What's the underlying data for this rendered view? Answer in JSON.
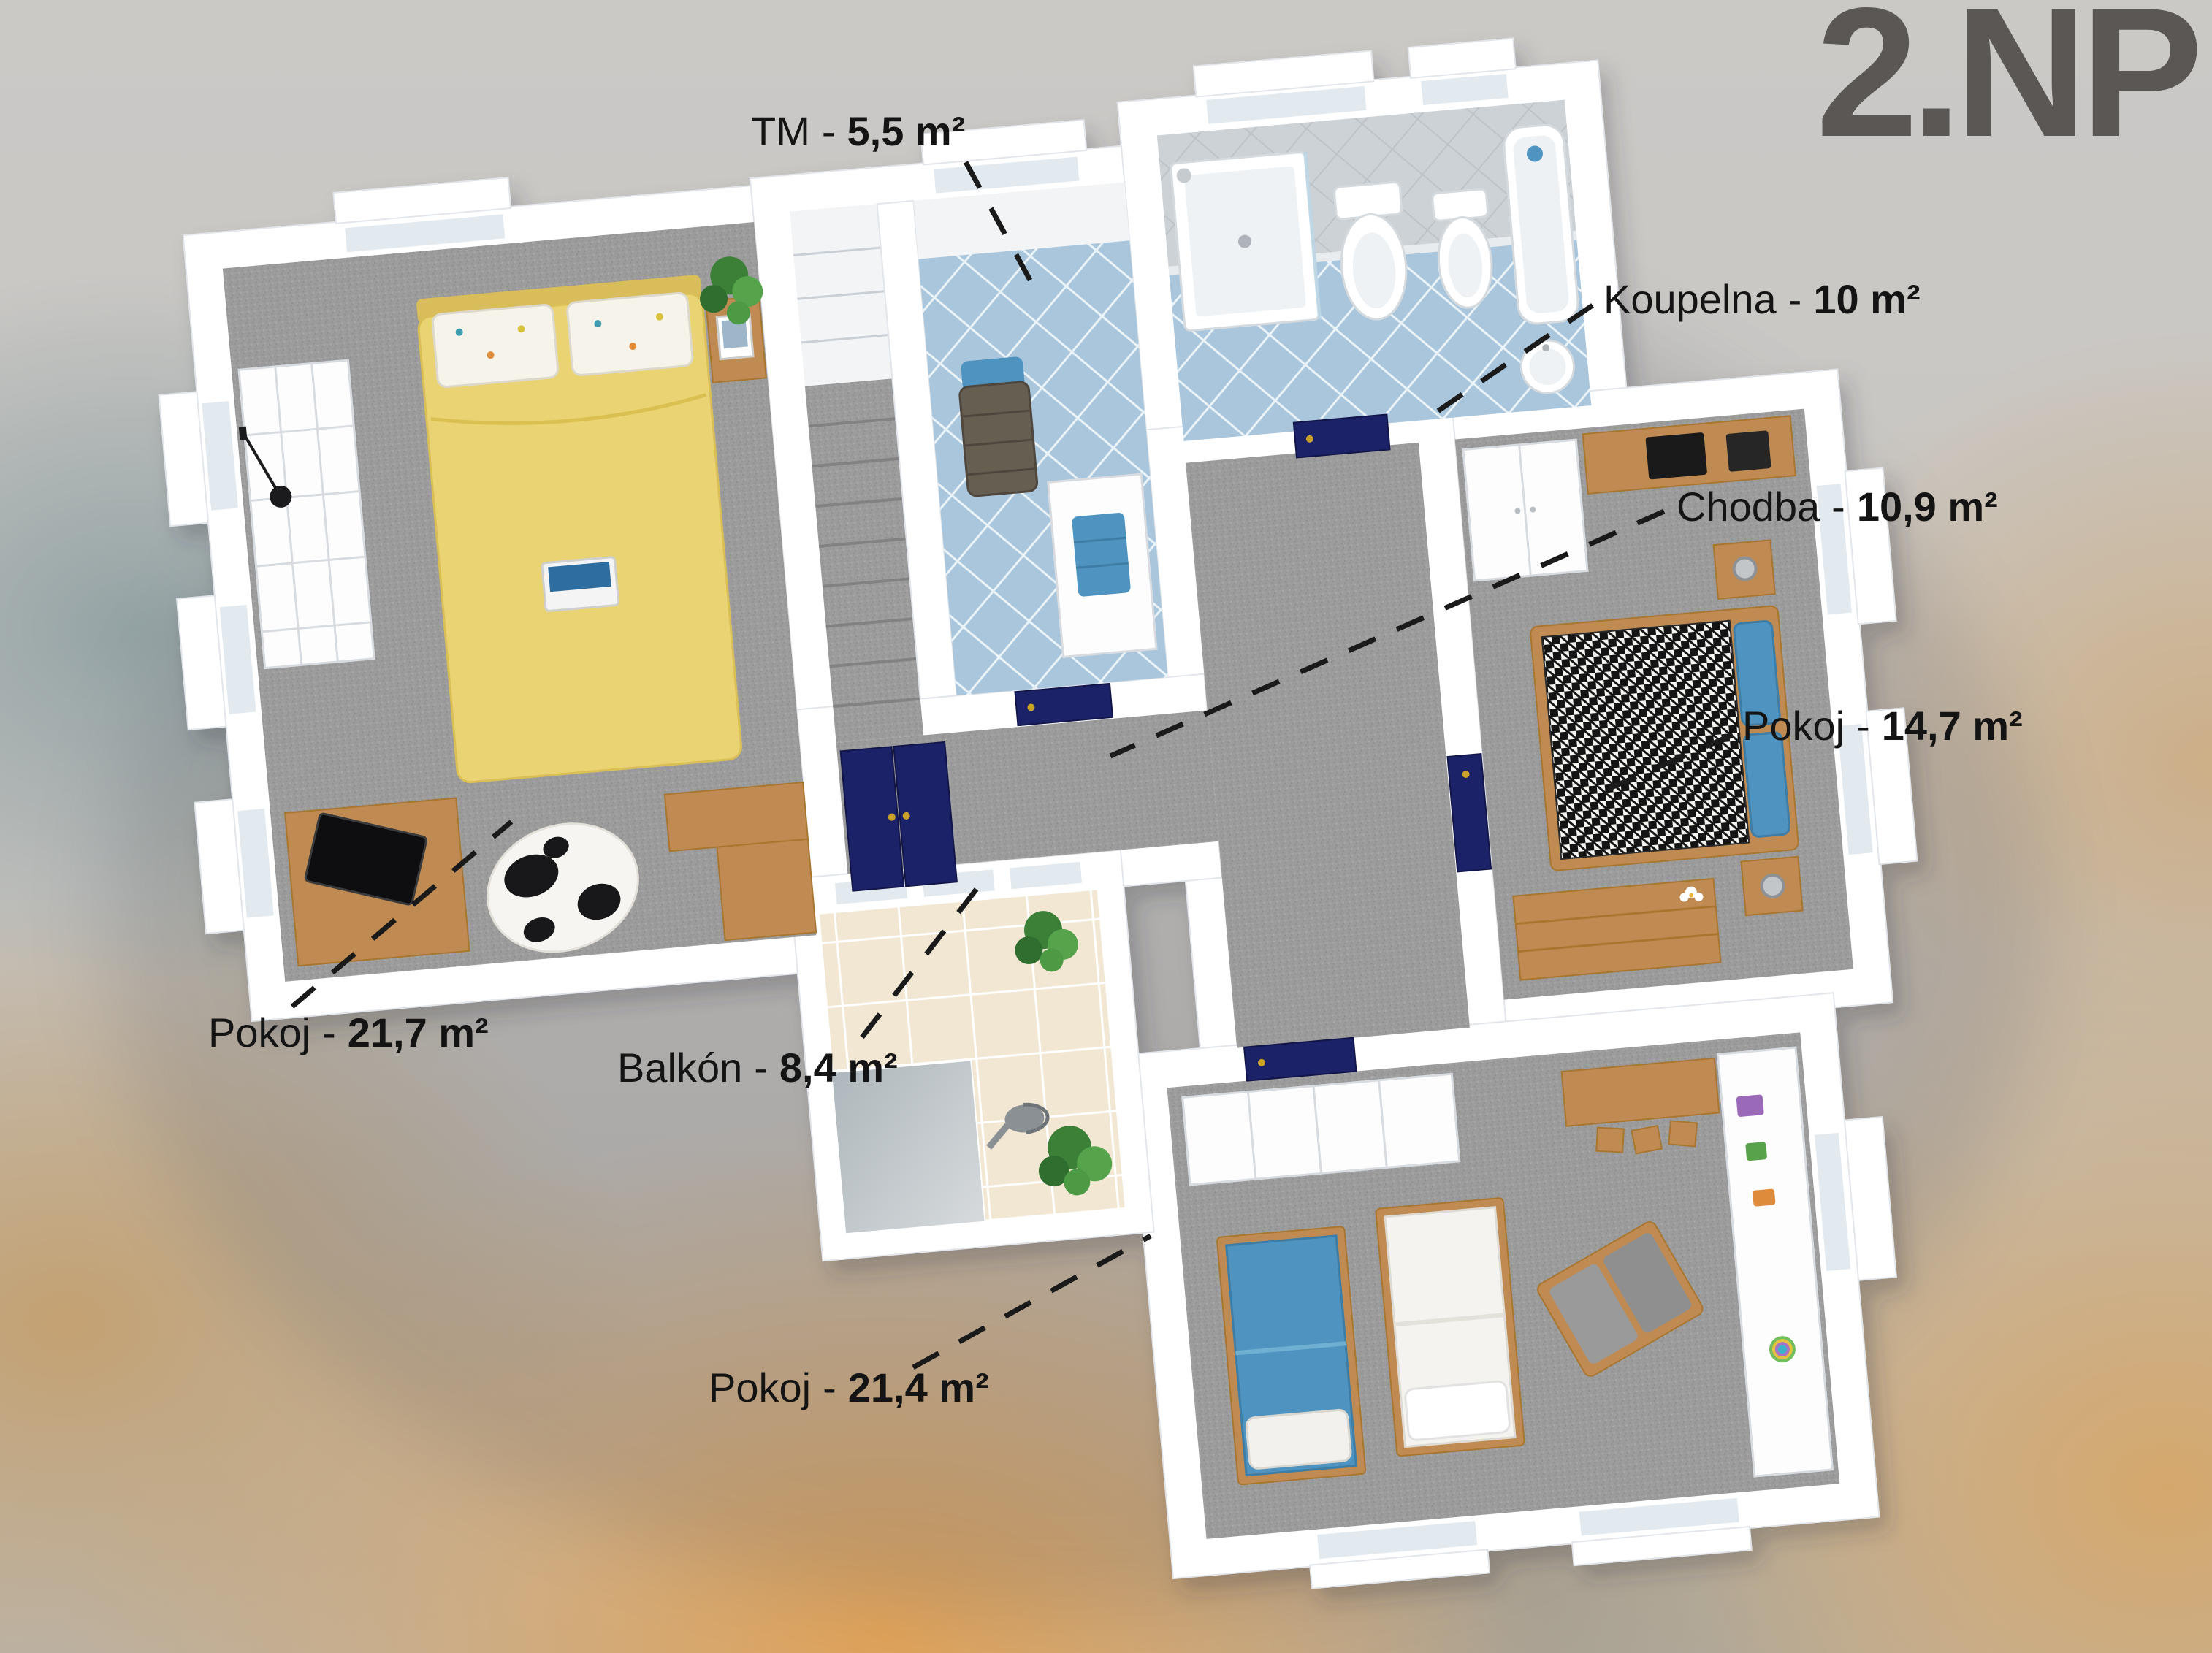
{
  "title": "2.NP",
  "separator": "-",
  "rooms": [
    {
      "id": "tm",
      "name": "TM",
      "area": "5,5 m²"
    },
    {
      "id": "koupelna",
      "name": "Koupelna",
      "area": "10 m²"
    },
    {
      "id": "chodba",
      "name": "Chodba",
      "area": "10,9 m²"
    },
    {
      "id": "pokoj-14-7",
      "name": "Pokoj",
      "area": "14,7 m²"
    },
    {
      "id": "pokoj-21-7",
      "name": "Pokoj",
      "area": "21,7 m²"
    },
    {
      "id": "balkon",
      "name": "Balkón",
      "area": "8,4 m²"
    },
    {
      "id": "pokoj-21-4",
      "name": "Pokoj",
      "area": "21,4 m²"
    }
  ],
  "colors": {
    "title": "#5a5755",
    "label": "#141414",
    "navy": "#1c2267",
    "wood": "#c08b52",
    "accent_blue": "#4f93c0",
    "bed_yellow": "#e9d372",
    "tile_blue": "#a9c6dc",
    "balcony_tile": "#f1e7d3"
  }
}
